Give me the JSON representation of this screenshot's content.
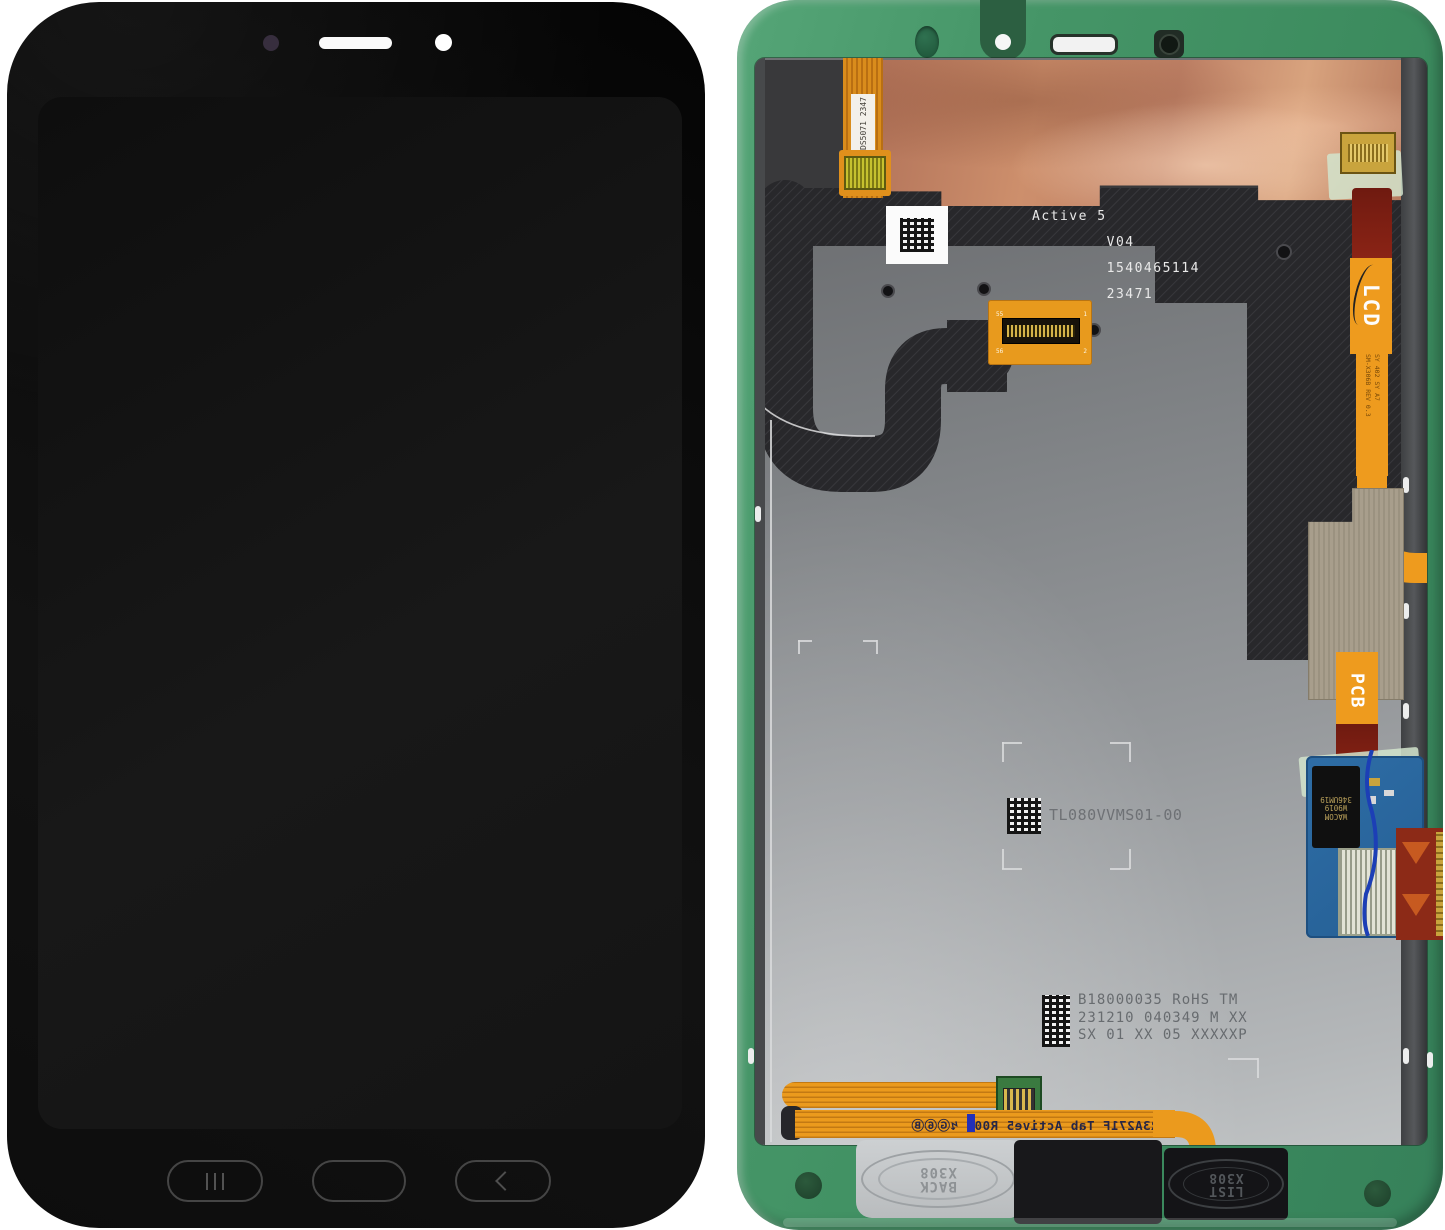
{
  "scene": {
    "description": "Product photo: tablet LCD display assembly, front and back views on white background",
    "background_color": "#ffffff",
    "accent_colors": {
      "frame_green": "#3f9164",
      "copper_foil": "#c4856a",
      "shield_silver": "#9b9ea1",
      "flex_orange": "#ee9b1e",
      "flex_dark_red": "#7a1d12",
      "digitizer_blue": "#2e6da6"
    }
  },
  "front_view": {
    "body": "tablet front, black bezel",
    "top_features": [
      "ambient-sensor dot",
      "earpiece slot",
      "front camera"
    ],
    "buttons": {
      "recent": "|||",
      "home": "",
      "back": "chevron-left"
    }
  },
  "back_view": {
    "frame": "green service frame",
    "top_left_flex_label_line1": "DS5071",
    "top_left_flex_label_line2": "2347",
    "main_label": {
      "line1": "Active 5",
      "line2": "V04",
      "line3": "1540465114",
      "line4": "23471"
    },
    "connector_pins": {
      "p55": "55",
      "p1": "1",
      "p56": "56",
      "p2": "2"
    },
    "lcd_flex_label": "LCD",
    "lcd_flex_small_1": "SM-X306B",
    "lcd_flex_small_2": "REV 0.3",
    "lcd_flex_small_3": "SY 402 SY A7",
    "pcb_flex_label": "PCB",
    "panel_model": "TL080VVMS01-00",
    "bottom_label": {
      "line1": "B18000035 RoHS TM",
      "line2": "231210 040349 M XX",
      "line3": "SX 01 XX 05 XXXXXP"
    },
    "digitizer_chip": {
      "line1": "WACOM",
      "line2": "W9019",
      "line3": "346UM19"
    },
    "bottom_ribbon_mirrored_text": "DR3A271F Tab Active5 R00",
    "bottom_ribbon_symbols": "↯Ⓖ⑥Ⓑ",
    "back_button": {
      "line1": "BACK",
      "line2": "X308"
    },
    "list_button": {
      "line1": "LIST",
      "line2": "X308"
    }
  }
}
